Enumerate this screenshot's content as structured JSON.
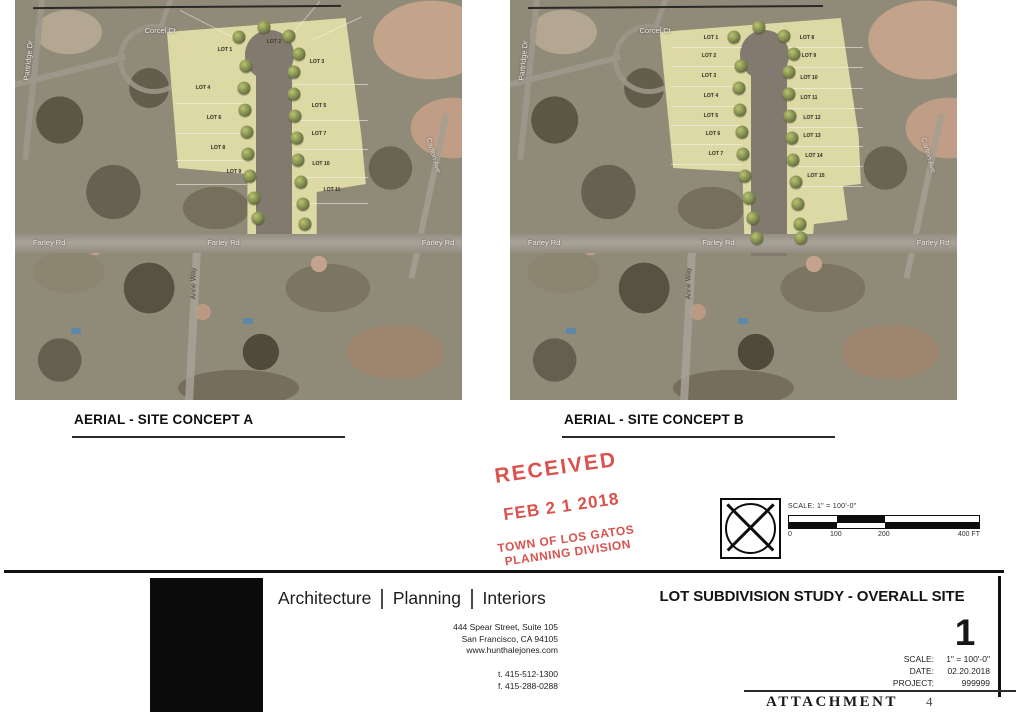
{
  "streets": {
    "corcel_ct": "Corcel Ct",
    "partridge_dr": "Partridge Dr",
    "farley_rd": "Farley Rd",
    "anne_way": "Anne Way",
    "carlton_ave": "Carlton Ave"
  },
  "concepts": [
    {
      "caption": "AERIAL - SITE CONCEPT A",
      "lots": [
        {
          "label": "LOT 1",
          "x": 47,
          "y": 12.5,
          "col": "T"
        },
        {
          "label": "LOT 2",
          "x": 58,
          "y": 10.5,
          "col": "T"
        },
        {
          "label": "LOT 3",
          "x": 67.5,
          "y": 15.5,
          "col": "R"
        },
        {
          "label": "LOT 4",
          "x": 42,
          "y": 22,
          "col": "L"
        },
        {
          "label": "LOT 5",
          "x": 68,
          "y": 26.5,
          "col": "R"
        },
        {
          "label": "LOT 6",
          "x": 44.5,
          "y": 29.5,
          "col": "L"
        },
        {
          "label": "LOT 7",
          "x": 68,
          "y": 33.5,
          "col": "R"
        },
        {
          "label": "LOT 8",
          "x": 45.5,
          "y": 37,
          "col": "L"
        },
        {
          "label": "LOT 9",
          "x": 49,
          "y": 43,
          "col": "L"
        },
        {
          "label": "LOT 10",
          "x": 68.5,
          "y": 41,
          "col": "R"
        },
        {
          "label": "LOT 11",
          "x": 71,
          "y": 47.5,
          "col": "R"
        }
      ]
    },
    {
      "caption": "AERIAL - SITE CONCEPT B",
      "lots": [
        {
          "label": "LOT 1",
          "x": 45,
          "y": 9.5,
          "col": "L"
        },
        {
          "label": "LOT 2",
          "x": 44.5,
          "y": 14,
          "col": "L"
        },
        {
          "label": "LOT 3",
          "x": 44.5,
          "y": 19,
          "col": "L"
        },
        {
          "label": "LOT 4",
          "x": 45,
          "y": 24,
          "col": "L"
        },
        {
          "label": "LOT 5",
          "x": 45,
          "y": 29,
          "col": "L"
        },
        {
          "label": "LOT 6",
          "x": 45.5,
          "y": 33.5,
          "col": "L"
        },
        {
          "label": "LOT 7",
          "x": 46,
          "y": 38.5,
          "col": "L"
        },
        {
          "label": "LOT 8",
          "x": 66.5,
          "y": 9.5,
          "col": "R"
        },
        {
          "label": "LOT 9",
          "x": 67,
          "y": 14,
          "col": "R"
        },
        {
          "label": "LOT 10",
          "x": 67,
          "y": 19.5,
          "col": "R"
        },
        {
          "label": "LOT 11",
          "x": 67,
          "y": 24.5,
          "col": "R"
        },
        {
          "label": "LOT 12",
          "x": 67.5,
          "y": 29.5,
          "col": "R"
        },
        {
          "label": "LOT 13",
          "x": 67.5,
          "y": 34,
          "col": "R"
        },
        {
          "label": "LOT 14",
          "x": 68,
          "y": 39,
          "col": "R"
        },
        {
          "label": "LOT 15",
          "x": 68.5,
          "y": 44,
          "col": "R"
        }
      ]
    }
  ],
  "stamp": {
    "received": "RECEIVED",
    "date": "FEB 2 1 2018",
    "org_line1": "TOWN OF LOS GATOS",
    "org_line2": "PLANNING DIVISION",
    "color": "#d6443e"
  },
  "scalebar": {
    "label": "SCALE: 1\" = 100'-0\"",
    "ticks": [
      "0",
      "100",
      "200",
      "400 FT"
    ]
  },
  "title_block": {
    "firm_words": [
      "Architecture",
      "Planning",
      "Interiors"
    ],
    "address_lines": [
      "444 Spear Street, Suite 105",
      "San Francisco, CA 94105",
      "www.hunthalejones.com"
    ],
    "phone_lines": [
      "t. 415-512-1300",
      "f. 415-288-0288"
    ],
    "sheet_title": "LOT SUBDIVISION STUDY - OVERALL SITE",
    "sheet_number": "1",
    "meta": [
      {
        "label": "SCALE:",
        "value": "1\" = 100'-0\""
      },
      {
        "label": "DATE:",
        "value": "02.20.2018"
      },
      {
        "label": "PROJECT:",
        "value": "999999"
      }
    ],
    "attachment_label": "ATTACHMENT",
    "attachment_number": "4"
  }
}
